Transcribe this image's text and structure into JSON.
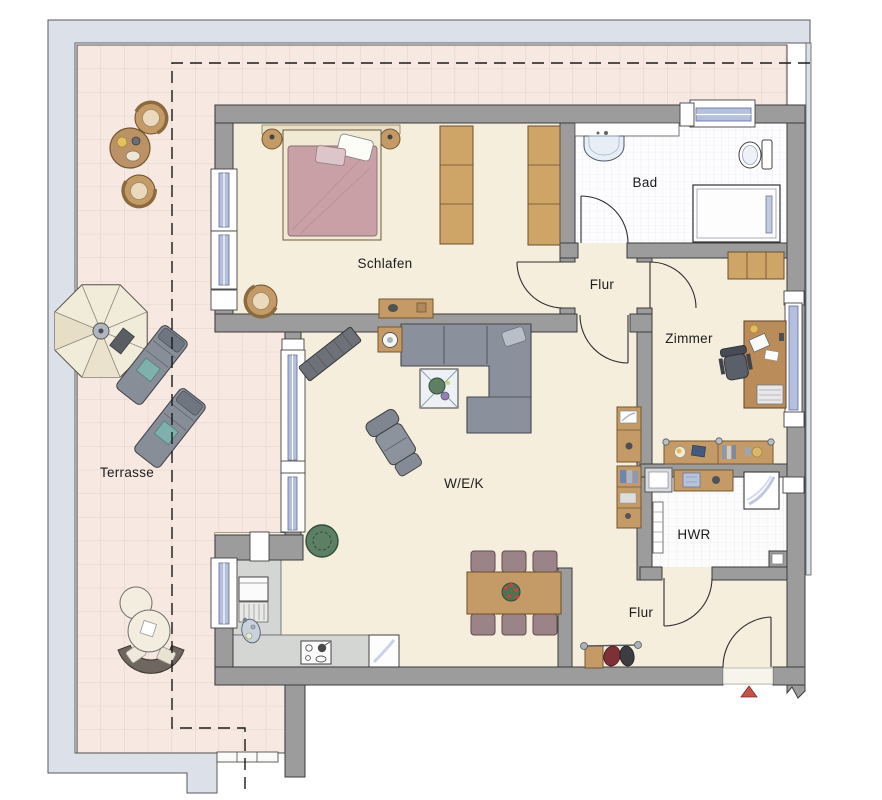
{
  "plan": {
    "type": "apartment-floor-plan",
    "rooms": {
      "terrace": {
        "label": "Terrasse"
      },
      "bedroom": {
        "label": "Schlafen"
      },
      "bathroom": {
        "label": "Bad"
      },
      "hall_upper": {
        "label": "Flur"
      },
      "room": {
        "label": "Zimmer"
      },
      "living_dining_kitchen": {
        "label": "W/E/K"
      },
      "utility": {
        "label": "HWR"
      },
      "hall_entrance": {
        "label": "Flur"
      }
    },
    "icons": {
      "entrance_arrow": "red-triangle-entrance-marker",
      "roof_overhang": "dashed-roof-overhang-line",
      "wall_break": "jagged-wall-cut",
      "stairs": "terrace-steps"
    },
    "colors": {
      "wall": "#9c9c9c",
      "wall_outline": "#3c3c3c",
      "floor": "#f5eedc",
      "terrace_tile": "#f7e9e1",
      "terrace_grid": "#e2d2cb",
      "bath_tile": "#fdfdff",
      "pavement": "#dce1e9",
      "window_glass": "#b4c0de",
      "wood": "#c49a66",
      "sofa_gray": "#8b919c",
      "bed_duvet": "#c9a0a5",
      "chair_mauve": "#9b8487",
      "plant_green": "#5d7f63",
      "counter_gray": "#d3d6d2",
      "entrance_arrow": "#c4534a"
    }
  }
}
